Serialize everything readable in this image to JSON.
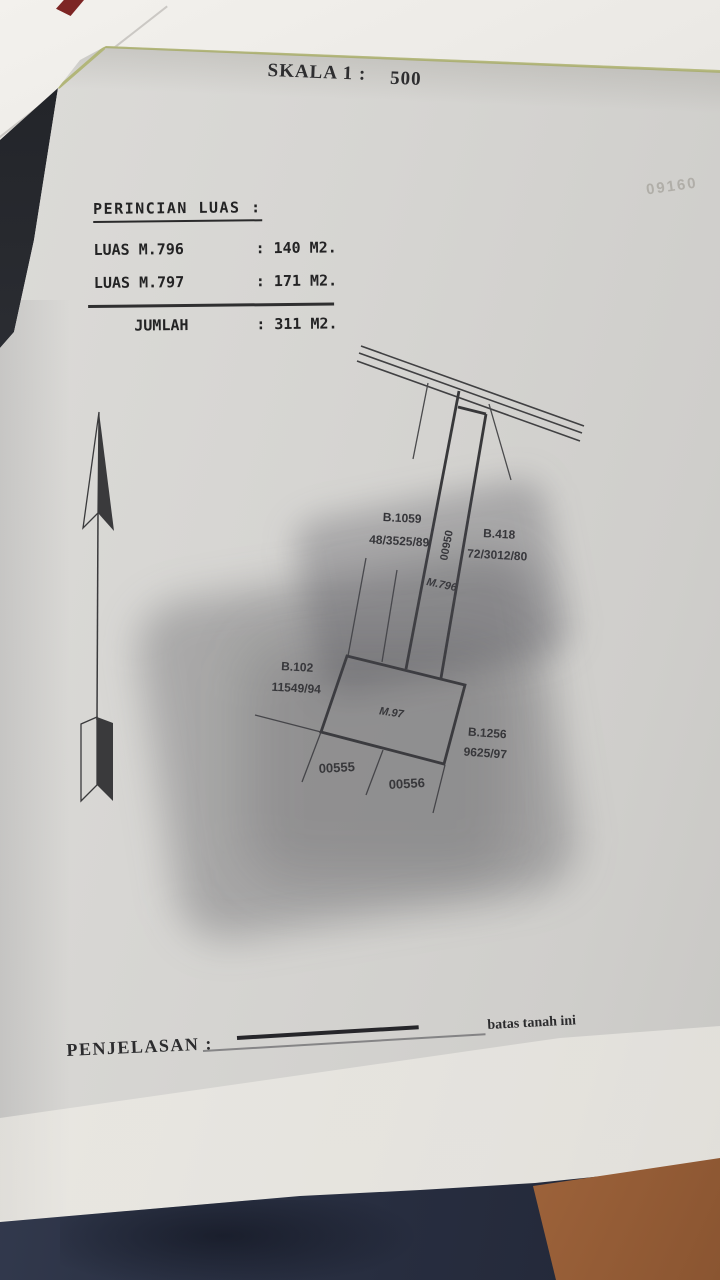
{
  "scale": {
    "label": "SKALA 1 :",
    "value": "500"
  },
  "area_details": {
    "title": "PERINCIAN LUAS :",
    "separator": ":",
    "rows": [
      {
        "label": "LUAS M.796",
        "value": "140 M2."
      },
      {
        "label": "LUAS M.797",
        "value": "171 M2."
      }
    ],
    "total": {
      "label": "JUMLAH",
      "value": "311 M2."
    }
  },
  "diagram": {
    "labels": {
      "b1059_line1": "B.1059",
      "b1059_line2": "48/3525/89",
      "strip_number": "00950",
      "b418_line1": "B.418",
      "b418_line2": "72/3012/80",
      "strip_parcel": "M.796",
      "b102_line1": "B.102",
      "b102_line2": "11549/94",
      "main_parcel": "M.97",
      "b1256_line1": "B.1256",
      "b1256_line2": "9625/97",
      "south_parcel_left": "00555",
      "south_parcel_right": "00556"
    }
  },
  "legend": {
    "boundary_label": "batas tanah ini",
    "explanation_label": "PENJELASAN :"
  },
  "artifacts": {
    "bleed_through_text": "09160"
  },
  "colors": {
    "paper": "#d6d5d2",
    "ink": "#2b2b2c",
    "page_edge_green": "#b2b679",
    "fabric_navy": "#2d3447",
    "skin": "#b5744a"
  }
}
